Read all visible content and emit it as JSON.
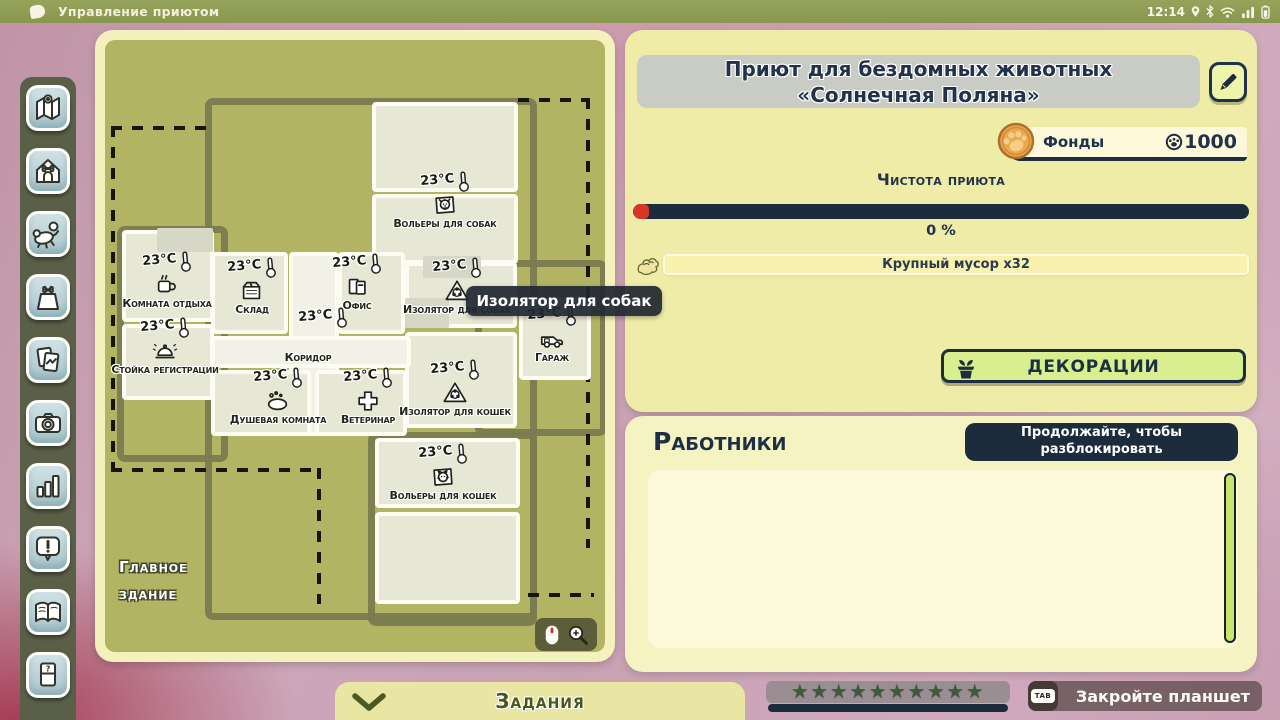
{
  "statusbar": {
    "app_title": "Управление приютом",
    "time": "12:14"
  },
  "sidebar": {
    "items": [
      {
        "name": "map"
      },
      {
        "name": "shelter"
      },
      {
        "name": "adoption"
      },
      {
        "name": "supplies"
      },
      {
        "name": "photos"
      },
      {
        "name": "camera"
      },
      {
        "name": "stats"
      },
      {
        "name": "alerts"
      },
      {
        "name": "journal"
      },
      {
        "name": "help"
      }
    ]
  },
  "map": {
    "tooltip": "Изолятор для собак",
    "area_label_line1": "Главное",
    "area_label_line2": "здание",
    "rooms": [
      {
        "x": 267,
        "y": 62,
        "w": 146,
        "h": 90,
        "fill": "room"
      },
      {
        "x": 267,
        "y": 154,
        "w": 146,
        "h": 70,
        "fill": "room"
      },
      {
        "x": 17,
        "y": 190,
        "w": 92,
        "h": 92,
        "fill": "room"
      },
      {
        "x": 52,
        "y": 188,
        "w": 56,
        "h": 24,
        "fill": "gray"
      },
      {
        "x": 17,
        "y": 284,
        "w": 92,
        "h": 76,
        "fill": "room"
      },
      {
        "x": 106,
        "y": 212,
        "w": 77,
        "h": 82,
        "fill": "room"
      },
      {
        "x": 233,
        "y": 212,
        "w": 67,
        "h": 82,
        "fill": "room"
      },
      {
        "x": 300,
        "y": 222,
        "w": 112,
        "h": 66,
        "fill": "room"
      },
      {
        "x": 318,
        "y": 216,
        "w": 58,
        "h": 22,
        "fill": "gray"
      },
      {
        "x": 300,
        "y": 292,
        "w": 112,
        "h": 96,
        "fill": "room"
      },
      {
        "x": 300,
        "y": 258,
        "w": 44,
        "h": 30,
        "fill": "gray"
      },
      {
        "x": 414,
        "y": 258,
        "w": 72,
        "h": 82,
        "fill": "room"
      },
      {
        "x": 184,
        "y": 212,
        "w": 50,
        "h": 184,
        "fill": "corridor"
      },
      {
        "x": 106,
        "y": 296,
        "w": 200,
        "h": 32,
        "fill": "corridor"
      },
      {
        "x": 106,
        "y": 330,
        "w": 100,
        "h": 66,
        "fill": "room"
      },
      {
        "x": 210,
        "y": 330,
        "w": 92,
        "h": 66,
        "fill": "room"
      },
      {
        "x": 270,
        "y": 398,
        "w": 145,
        "h": 70,
        "fill": "room"
      },
      {
        "x": 270,
        "y": 472,
        "w": 145,
        "h": 92,
        "fill": "room"
      }
    ],
    "markers": [
      {
        "cx": 340,
        "y": 132,
        "temp": "23°C",
        "icon": "dog-kennel",
        "label": "Вольеры для собак"
      },
      {
        "cx": 62,
        "y": 212,
        "temp": "23°C",
        "icon": "mug",
        "label": "Комната отдыха"
      },
      {
        "cx": 147,
        "y": 218,
        "temp": "23°C",
        "icon": "crate",
        "label": "Склад"
      },
      {
        "cx": 252,
        "y": 214,
        "temp": "23°C",
        "icon": "folders",
        "label": "Офис"
      },
      {
        "cx": 218,
        "y": 268,
        "temp": "23°C"
      },
      {
        "cx": 60,
        "y": 278,
        "temp": "23°C",
        "icon": "bell",
        "label": "Стойка регистрации"
      },
      {
        "cx": 203,
        "y": 312,
        "label": "Коридор"
      },
      {
        "cx": 173,
        "y": 328,
        "temp": "23°C",
        "icon": "soap",
        "label": "Душевая комната"
      },
      {
        "cx": 263,
        "y": 328,
        "temp": "23°C",
        "icon": "medical-cross",
        "label": "Ветеринар"
      },
      {
        "cx": 352,
        "y": 218,
        "temp": "23°C",
        "icon": "biohazard",
        "label": "Изолятор для собак"
      },
      {
        "cx": 350,
        "y": 320,
        "temp": "23°C",
        "icon": "biohazard",
        "label": "Изолятор для кошек"
      },
      {
        "cx": 447,
        "y": 266,
        "temp": "23°C",
        "icon": "van",
        "label": "Гараж"
      },
      {
        "cx": 338,
        "y": 404,
        "temp": "23°C",
        "icon": "cat-kennel",
        "label": "Вольеры для кошек"
      }
    ],
    "outlines": [
      {
        "x": 100,
        "y": 58,
        "w": 318,
        "h": 508
      },
      {
        "x": 12,
        "y": 186,
        "w": 97,
        "h": 222
      },
      {
        "x": 370,
        "y": 220,
        "w": 118,
        "h": 162
      },
      {
        "x": 263,
        "y": 392,
        "w": 155,
        "h": 180
      }
    ],
    "dashes": [
      {
        "x": 481,
        "y": 58,
        "w": 4,
        "h": 450
      },
      {
        "x": 413,
        "y": 58,
        "w": 72,
        "h": 4
      },
      {
        "x": 6,
        "y": 428,
        "w": 210,
        "h": 4
      },
      {
        "x": 212,
        "y": 428,
        "w": 4,
        "h": 136
      },
      {
        "x": 6,
        "y": 86,
        "w": 4,
        "h": 346
      },
      {
        "x": 6,
        "y": 86,
        "w": 98,
        "h": 4
      },
      {
        "x": 423,
        "y": 553,
        "w": 66,
        "h": 4
      }
    ]
  },
  "panel": {
    "title": "Приют для бездомных животных «Солнечная Поляна»",
    "funds_label": "Фонды",
    "funds_value": "1000",
    "cleanliness_title": "Чистота приюта",
    "cleanliness_percent": "0 %",
    "cleanliness_value": 0,
    "trash_label": "Крупный мусор x32",
    "decorations_label": "ДЕКОРАЦИИ",
    "workers_title": "Работники",
    "unlock_line1": "Продолжайте, чтобы",
    "unlock_line2": "разблокировать"
  },
  "bottom": {
    "tasks_label": "Задания",
    "stars_count": 10,
    "close_key": "TAB",
    "close_label": "Закройте планшет"
  },
  "colors": {
    "navy": "#1d2d3f",
    "panel_yellow": "#efeca7",
    "panel_yellow_light": "#f6f3c2",
    "map_olive": "#b2b464",
    "button_green": "#d8ee8f",
    "bar_red": "#d63726",
    "scrollbar_green": "#c8e46c",
    "coin_orange": "#eaa94f",
    "topbar_olive": "#8e9c54",
    "background_pink": "#c9a2b4"
  }
}
